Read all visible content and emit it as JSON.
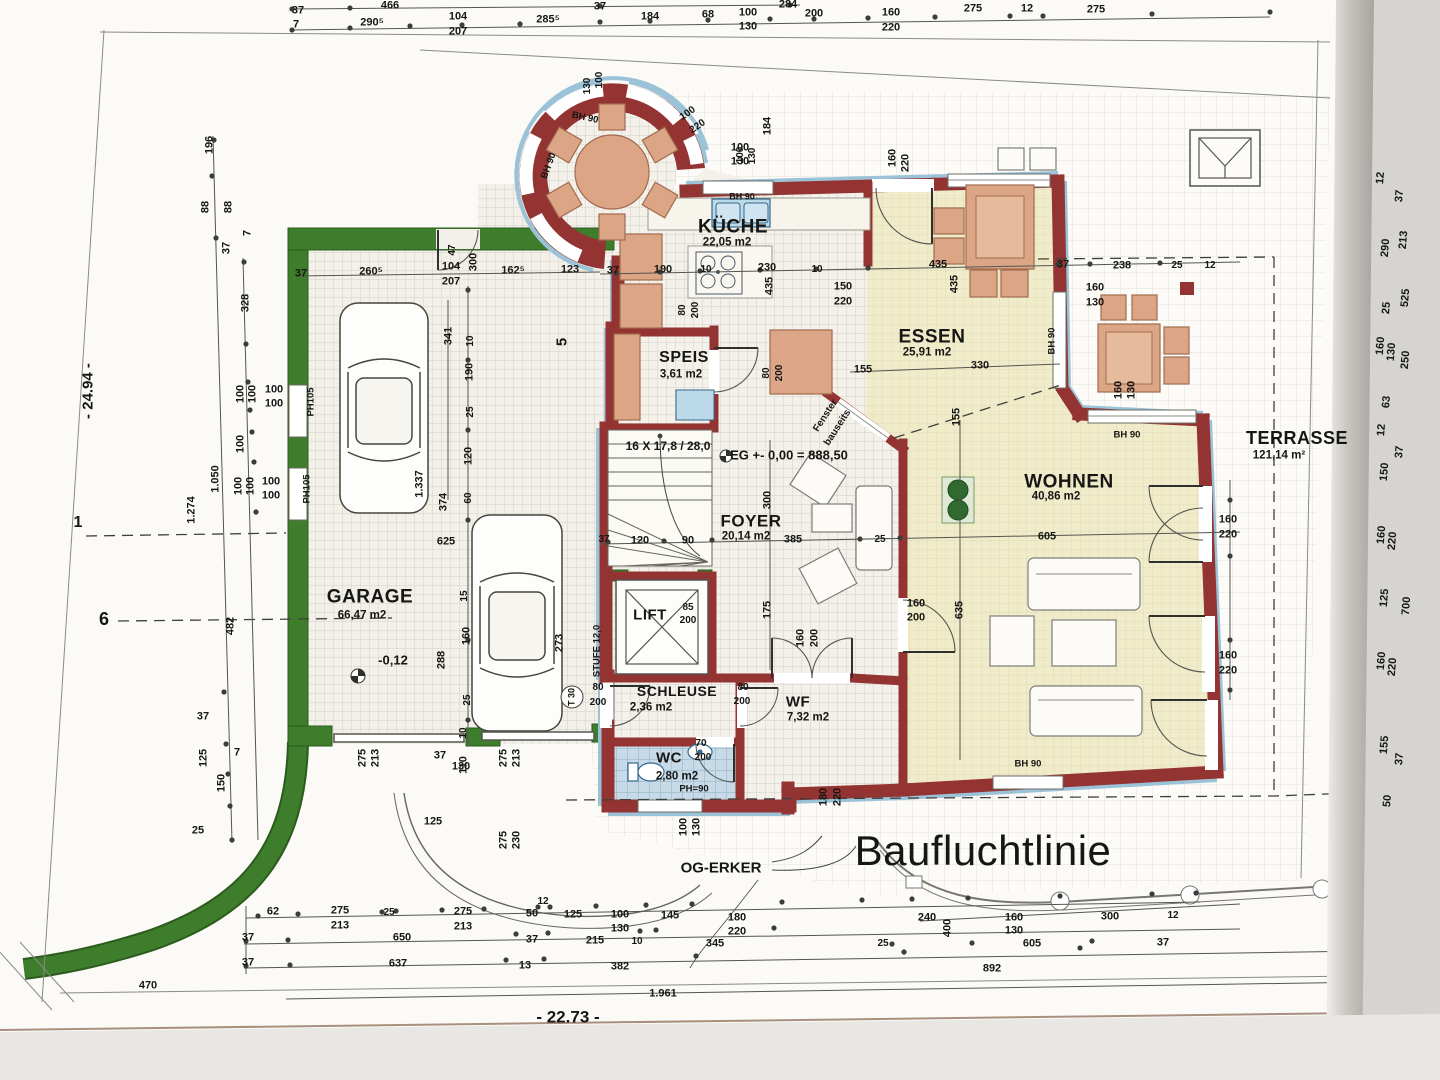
{
  "colors": {
    "wall": "#943432",
    "trim": "#9cc2d8",
    "green": "#3e7d2b",
    "greendark": "#2c5c1d",
    "warm": "#f0ecca",
    "floor": "#f3f1ea",
    "furn": "#dba586",
    "furnedge": "#a06c4d",
    "wet": "#c6dbe7",
    "appl": "#bcd9ea",
    "dimblue": "#274b8f",
    "line": "#555550",
    "text": "#161614"
  },
  "rooms": [
    {
      "name": "GARAGE",
      "area": "66,47 m2",
      "nx": 370,
      "ny": 597,
      "ax": 362,
      "ay": 616,
      "ns": 19
    },
    {
      "name": "KÜCHE",
      "area": "22,05 m2",
      "nx": 733,
      "ny": 227,
      "ax": 727,
      "ay": 243,
      "ns": 19
    },
    {
      "name": "SPEIS",
      "area": "3,61 m2",
      "nx": 684,
      "ny": 358,
      "ax": 681,
      "ay": 375,
      "ns": 16
    },
    {
      "name": "ESSEN",
      "area": "25,91 m2",
      "nx": 932,
      "ny": 337,
      "ax": 927,
      "ay": 353,
      "ns": 19
    },
    {
      "name": "WOHNEN",
      "area": "40,86 m2",
      "nx": 1069,
      "ny": 482,
      "ax": 1056,
      "ay": 497,
      "ns": 19
    },
    {
      "name": "FOYER",
      "area": "20,14 m2",
      "nx": 751,
      "ny": 521,
      "ax": 746,
      "ay": 537,
      "ns": 17
    },
    {
      "name": "TERRASSE",
      "area": "121,14 m²",
      "nx": 1297,
      "ny": 438,
      "ax": 1279,
      "ay": 456,
      "ns": 18
    },
    {
      "name": "LIFT",
      "area": "",
      "nx": 650,
      "ny": 615,
      "ax": 650,
      "ay": 630,
      "ns": 15
    },
    {
      "name": "SCHLEUSE",
      "area": "2,36 m2",
      "nx": 677,
      "ny": 691,
      "ax": 651,
      "ay": 708,
      "ns": 14
    },
    {
      "name": "WF",
      "area": "7,32 m2",
      "nx": 798,
      "ny": 702,
      "ax": 808,
      "ay": 718,
      "ns": 15
    },
    {
      "name": "WC",
      "area": "2,80 m2",
      "nx": 669,
      "ny": 758,
      "ax": 677,
      "ay": 777,
      "ns": 15
    }
  ],
  "annotations": [
    {
      "t": "Baufluchtlinie",
      "x": 983,
      "y": 851,
      "s": 42,
      "cls": "big"
    },
    {
      "t": "OG-ERKER",
      "x": 721,
      "y": 868,
      "s": 15,
      "cls": "boxed"
    },
    {
      "t": "EG +- 0,00 = 888,50",
      "x": 789,
      "y": 455,
      "s": 13,
      "cls": "boxed italic"
    },
    {
      "t": "16 X 17,8 / 28,0",
      "x": 668,
      "y": 446,
      "s": 12
    },
    {
      "t": "Fenster",
      "x": 826,
      "y": 416,
      "s": 10,
      "r": -57
    },
    {
      "t": "bauseits",
      "x": 838,
      "y": 428,
      "s": 10,
      "r": -57
    },
    {
      "t": "-0,12",
      "x": 393,
      "y": 660,
      "s": 13,
      "cls": "boxed italic"
    },
    {
      "t": "STUFE 12,0",
      "x": 597,
      "y": 651,
      "s": 9.5,
      "r": -90
    },
    {
      "t": "T 30",
      "x": 572,
      "y": 697,
      "s": 9,
      "r": -90
    },
    {
      "t": "- 24.94 -",
      "x": 88,
      "y": 391,
      "s": 15,
      "r": -90,
      "cls": "blue"
    },
    {
      "t": "- 22.73 -",
      "x": 568,
      "y": 1017,
      "s": 17,
      "cls": "blue"
    },
    {
      "t": "1",
      "x": 78,
      "y": 523,
      "s": 16,
      "cls": "muted"
    },
    {
      "t": "6",
      "x": 104,
      "y": 619,
      "s": 18,
      "cls": "muted"
    },
    {
      "t": "5",
      "x": 562,
      "y": 342,
      "s": 15,
      "r": -90,
      "cls": "muted"
    }
  ],
  "dims": [
    [
      "37",
      298,
      11
    ],
    [
      "466",
      390,
      6
    ],
    [
      "37",
      600,
      7
    ],
    [
      "284",
      788,
      5
    ],
    [
      "7",
      296,
      25
    ],
    [
      "290⁵",
      372,
      23
    ],
    [
      "104",
      458,
      17
    ],
    [
      "207",
      458,
      32
    ],
    [
      "285⁵",
      548,
      20
    ],
    [
      "184",
      650,
      17
    ],
    [
      "68",
      708,
      15
    ],
    [
      "100",
      748,
      13
    ],
    [
      "130",
      748,
      27
    ],
    [
      "200",
      814,
      14
    ],
    [
      "160",
      891,
      13
    ],
    [
      "220",
      891,
      28
    ],
    [
      "275",
      973,
      9
    ],
    [
      "12",
      1027,
      9
    ],
    [
      "275",
      1096,
      10
    ],
    [
      "196",
      210,
      145,
      -90
    ],
    [
      "88",
      206,
      207,
      -90
    ],
    [
      "88",
      229,
      207,
      -90
    ],
    [
      "37",
      227,
      248,
      -90
    ],
    [
      "7",
      248,
      233,
      -90
    ],
    [
      "328",
      246,
      303,
      -90
    ],
    [
      "100",
      241,
      394,
      -90
    ],
    [
      "100",
      253,
      394,
      -90
    ],
    [
      "100",
      274,
      390
    ],
    [
      "100",
      274,
      404
    ],
    [
      "100",
      241,
      444,
      -90
    ],
    [
      "100",
      239,
      486,
      -90
    ],
    [
      "100",
      251,
      486,
      -90
    ],
    [
      "100",
      271,
      482
    ],
    [
      "100",
      271,
      496
    ],
    [
      "1.274",
      192,
      510,
      -90
    ],
    [
      "1.050",
      216,
      479,
      -90
    ],
    [
      "PH105",
      311,
      402,
      -90,
      9.5
    ],
    [
      "PH105",
      307,
      489,
      -90,
      9.5
    ],
    [
      "482",
      231,
      626,
      -90
    ],
    [
      "37",
      203,
      717
    ],
    [
      "7",
      237,
      753
    ],
    [
      "125",
      204,
      758,
      -90
    ],
    [
      "150",
      222,
      783,
      -90
    ],
    [
      "25",
      198,
      831
    ],
    [
      "37",
      301,
      274
    ],
    [
      "260⁵",
      371,
      272
    ],
    [
      "104",
      451,
      267
    ],
    [
      "207",
      451,
      282
    ],
    [
      "47",
      453,
      250,
      -90,
      10
    ],
    [
      "300",
      474,
      262,
      -90
    ],
    [
      "162⁵",
      513,
      271
    ],
    [
      "123",
      570,
      270
    ],
    [
      "341",
      449,
      336,
      -90
    ],
    [
      "10",
      471,
      341,
      -90,
      10
    ],
    [
      "190",
      470,
      372,
      -90
    ],
    [
      "25",
      471,
      412,
      -90,
      10
    ],
    [
      "120",
      469,
      456,
      -90
    ],
    [
      "1.337",
      420,
      484,
      -90
    ],
    [
      "374",
      444,
      502,
      -90
    ],
    [
      "60",
      469,
      498,
      -90,
      10
    ],
    [
      "625",
      446,
      542
    ],
    [
      "15",
      465,
      596,
      -90,
      10
    ],
    [
      "160",
      467,
      636,
      -90
    ],
    [
      "25",
      468,
      700,
      -90,
      10
    ],
    [
      "288",
      442,
      660,
      -90
    ],
    [
      "273",
      560,
      643,
      -90
    ],
    [
      "110",
      464,
      765,
      -90
    ],
    [
      "10",
      464,
      733,
      -90,
      10
    ],
    [
      "37",
      440,
      756
    ],
    [
      "130",
      461,
      767
    ],
    [
      "275",
      363,
      758,
      -90
    ],
    [
      "213",
      376,
      758,
      -90
    ],
    [
      "275",
      504,
      758,
      -90
    ],
    [
      "213",
      517,
      758,
      -90
    ],
    [
      "275",
      504,
      840,
      -90
    ],
    [
      "230",
      517,
      840,
      -90
    ],
    [
      "125",
      433,
      822
    ],
    [
      "37",
      613,
      271
    ],
    [
      "190",
      663,
      270
    ],
    [
      "10",
      706,
      270,
      0,
      10
    ],
    [
      "230",
      767,
      268
    ],
    [
      "10",
      817,
      270,
      0,
      10
    ],
    [
      "150",
      843,
      287
    ],
    [
      "220",
      843,
      302
    ],
    [
      "435",
      770,
      286,
      -90
    ],
    [
      "435",
      938,
      265
    ],
    [
      "37",
      1063,
      265
    ],
    [
      "238",
      1122,
      266
    ],
    [
      "25",
      1177,
      266,
      0,
      10
    ],
    [
      "12",
      1210,
      266,
      0,
      10
    ],
    [
      "435",
      955,
      284,
      -90
    ],
    [
      "155",
      863,
      370
    ],
    [
      "330",
      980,
      366
    ],
    [
      "155",
      957,
      417,
      -90
    ],
    [
      "100",
      740,
      148
    ],
    [
      "130",
      740,
      162
    ],
    [
      "184",
      768,
      126,
      -90
    ],
    [
      "160",
      893,
      158,
      -90
    ],
    [
      "220",
      906,
      163,
      -90
    ],
    [
      "BH 90",
      742,
      197,
      0,
      9
    ],
    [
      "BH 90",
      585,
      118,
      12,
      9.5
    ],
    [
      "BH 90",
      549,
      166,
      -70,
      9.5
    ],
    [
      "100",
      600,
      80,
      -90,
      10
    ],
    [
      "130",
      588,
      86,
      -90,
      10
    ],
    [
      "100",
      688,
      114,
      -35,
      10
    ],
    [
      "220",
      698,
      127,
      -35,
      10
    ],
    [
      "100",
      741,
      155,
      -90,
      10
    ],
    [
      "130",
      753,
      156,
      -90,
      10
    ],
    [
      "BH 90",
      1052,
      341,
      -90,
      9.5
    ],
    [
      "160",
      1095,
      288
    ],
    [
      "130",
      1095,
      303
    ],
    [
      "160",
      1119,
      390,
      -90
    ],
    [
      "130",
      1132,
      390,
      -90
    ],
    [
      "BH 90",
      1127,
      435,
      0,
      9.5
    ],
    [
      "80",
      683,
      310,
      -90,
      10
    ],
    [
      "200",
      696,
      310,
      -90,
      10
    ],
    [
      "80",
      767,
      373,
      -90,
      10
    ],
    [
      "200",
      780,
      373,
      -90,
      10
    ],
    [
      "37",
      604,
      540,
      0,
      10
    ],
    [
      "120",
      640,
      541
    ],
    [
      "90",
      688,
      541
    ],
    [
      "385",
      793,
      540
    ],
    [
      "25",
      880,
      540,
      0,
      10
    ],
    [
      "605",
      1047,
      537
    ],
    [
      "300",
      768,
      500,
      -90
    ],
    [
      "175",
      768,
      610,
      -90
    ],
    [
      "635",
      960,
      610,
      -90
    ],
    [
      "160",
      916,
      604
    ],
    [
      "200",
      916,
      618
    ],
    [
      "160",
      801,
      638,
      -90
    ],
    [
      "200",
      815,
      638,
      -90
    ],
    [
      "85",
      688,
      608,
      0,
      10
    ],
    [
      "200",
      688,
      621,
      0,
      10
    ],
    [
      "160",
      1228,
      520
    ],
    [
      "220",
      1228,
      535
    ],
    [
      "160",
      1228,
      656
    ],
    [
      "220",
      1228,
      671
    ],
    [
      "BH 90",
      1028,
      764,
      0,
      9.5
    ],
    [
      "180",
      824,
      797,
      -90
    ],
    [
      "220",
      838,
      797,
      -90
    ],
    [
      "100",
      684,
      827,
      -90
    ],
    [
      "130",
      697,
      827,
      -90
    ],
    [
      "80",
      598,
      688,
      0,
      10
    ],
    [
      "200",
      598,
      703,
      0,
      10
    ],
    [
      "80",
      743,
      688,
      0,
      10
    ],
    [
      "200",
      742,
      702,
      0,
      10
    ],
    [
      "70",
      701,
      744,
      0,
      10
    ],
    [
      "200",
      703,
      758,
      0,
      10
    ],
    [
      "PH=90",
      694,
      789,
      0,
      9.5
    ],
    [
      "62",
      273,
      912
    ],
    [
      "275",
      340,
      911
    ],
    [
      "213",
      340,
      926
    ],
    [
      "25",
      389,
      913,
      0,
      10
    ],
    [
      "275",
      463,
      912
    ],
    [
      "213",
      463,
      927
    ],
    [
      "50",
      532,
      914
    ],
    [
      "12",
      543,
      902,
      0,
      10
    ],
    [
      "125",
      573,
      915
    ],
    [
      "100",
      620,
      915
    ],
    [
      "130",
      620,
      929
    ],
    [
      "145",
      670,
      916
    ],
    [
      "180",
      737,
      918
    ],
    [
      "220",
      737,
      932
    ],
    [
      "240",
      927,
      918
    ],
    [
      "400",
      948,
      928,
      -90
    ],
    [
      "160",
      1014,
      918
    ],
    [
      "130",
      1014,
      931
    ],
    [
      "300",
      1110,
      917
    ],
    [
      "12",
      1173,
      916,
      0,
      10
    ],
    [
      "37",
      248,
      938
    ],
    [
      "650",
      402,
      938
    ],
    [
      "37",
      532,
      940
    ],
    [
      "215",
      595,
      941
    ],
    [
      "10",
      637,
      942,
      0,
      10
    ],
    [
      "345",
      715,
      944
    ],
    [
      "25",
      883,
      944,
      0,
      10
    ],
    [
      "605",
      1032,
      944
    ],
    [
      "37",
      1163,
      943
    ],
    [
      "37",
      248,
      963
    ],
    [
      "637",
      398,
      964
    ],
    [
      "13",
      525,
      966
    ],
    [
      "382",
      620,
      967
    ],
    [
      "892",
      992,
      969
    ],
    [
      "1.961",
      663,
      994
    ],
    [
      "470",
      148,
      986
    ],
    [
      "12",
      1381,
      178,
      -85
    ],
    [
      "37",
      1400,
      196,
      -85
    ],
    [
      "290",
      1386,
      248,
      -85
    ],
    [
      "213",
      1404,
      240,
      -85
    ],
    [
      "25",
      1387,
      308,
      -85
    ],
    [
      "525",
      1406,
      298,
      -85
    ],
    [
      "160",
      1381,
      346,
      -85
    ],
    [
      "130",
      1392,
      352,
      -85
    ],
    [
      "250",
      1406,
      360,
      -85
    ],
    [
      "63",
      1387,
      402,
      -85
    ],
    [
      "12",
      1382,
      430,
      -85
    ],
    [
      "37",
      1400,
      452,
      -85
    ],
    [
      "150",
      1385,
      472,
      -85
    ],
    [
      "160",
      1382,
      535,
      -85
    ],
    [
      "220",
      1393,
      541,
      -85
    ],
    [
      "125",
      1385,
      598,
      -85
    ],
    [
      "700",
      1407,
      606,
      -85
    ],
    [
      "160",
      1382,
      661,
      -85
    ],
    [
      "220",
      1393,
      667,
      -85
    ],
    [
      "155",
      1385,
      745,
      -85
    ],
    [
      "37",
      1400,
      759,
      -85
    ],
    [
      "50",
      1388,
      801,
      -85
    ]
  ],
  "ticks": [
    [
      292,
      30
    ],
    [
      350,
      28
    ],
    [
      410,
      26
    ],
    [
      462,
      25
    ],
    [
      520,
      24
    ],
    [
      600,
      22
    ],
    [
      650,
      21
    ],
    [
      708,
      20
    ],
    [
      770,
      19
    ],
    [
      814,
      19
    ],
    [
      868,
      18
    ],
    [
      935,
      17
    ],
    [
      1010,
      16
    ],
    [
      1043,
      16
    ],
    [
      1152,
      14
    ],
    [
      1270,
      12
    ],
    [
      292,
      9
    ],
    [
      350,
      8
    ],
    [
      600,
      6
    ],
    [
      790,
      5
    ],
    [
      214,
      140
    ],
    [
      212,
      176
    ],
    [
      216,
      238
    ],
    [
      244,
      262
    ],
    [
      246,
      344
    ],
    [
      248,
      382
    ],
    [
      250,
      410
    ],
    [
      252,
      432
    ],
    [
      254,
      462
    ],
    [
      256,
      512
    ],
    [
      224,
      692
    ],
    [
      226,
      744
    ],
    [
      228,
      774
    ],
    [
      230,
      806
    ],
    [
      232,
      840
    ],
    [
      258,
      916
    ],
    [
      298,
      914
    ],
    [
      382,
      912
    ],
    [
      396,
      911
    ],
    [
      442,
      910
    ],
    [
      484,
      909
    ],
    [
      538,
      907
    ],
    [
      550,
      907
    ],
    [
      596,
      906
    ],
    [
      646,
      905
    ],
    [
      692,
      904
    ],
    [
      782,
      902
    ],
    [
      862,
      900
    ],
    [
      912,
      899
    ],
    [
      968,
      898
    ],
    [
      1060,
      896
    ],
    [
      1152,
      894
    ],
    [
      1196,
      893
    ],
    [
      246,
      941
    ],
    [
      288,
      940
    ],
    [
      516,
      934
    ],
    [
      548,
      933
    ],
    [
      640,
      931
    ],
    [
      656,
      930
    ],
    [
      774,
      928
    ],
    [
      892,
      944
    ],
    [
      972,
      943
    ],
    [
      1092,
      941
    ],
    [
      246,
      966
    ],
    [
      290,
      965
    ],
    [
      506,
      960
    ],
    [
      544,
      959
    ],
    [
      696,
      956
    ],
    [
      904,
      952
    ],
    [
      1080,
      948
    ],
    [
      1376,
      170
    ],
    [
      1380,
      240
    ],
    [
      1383,
      300
    ],
    [
      1386,
      360
    ],
    [
      1389,
      420
    ],
    [
      1392,
      480
    ],
    [
      1395,
      540
    ],
    [
      1398,
      600
    ],
    [
      1401,
      660
    ],
    [
      1404,
      720
    ],
    [
      1407,
      780
    ],
    [
      1410,
      840
    ],
    [
      616,
      273
    ],
    [
      660,
      272
    ],
    [
      700,
      271
    ],
    [
      760,
      270
    ],
    [
      816,
      269
    ],
    [
      868,
      268
    ],
    [
      1058,
      264
    ],
    [
      1090,
      264
    ],
    [
      1160,
      263
    ],
    [
      468,
      290
    ],
    [
      468,
      360
    ],
    [
      468,
      430
    ],
    [
      468,
      520
    ],
    [
      468,
      640
    ],
    [
      468,
      720
    ],
    [
      608,
      542
    ],
    [
      664,
      541
    ],
    [
      712,
      540
    ],
    [
      860,
      539
    ],
    [
      900,
      538
    ],
    [
      1230,
      500
    ],
    [
      1230,
      556
    ],
    [
      1230,
      640
    ],
    [
      1230,
      690
    ]
  ]
}
